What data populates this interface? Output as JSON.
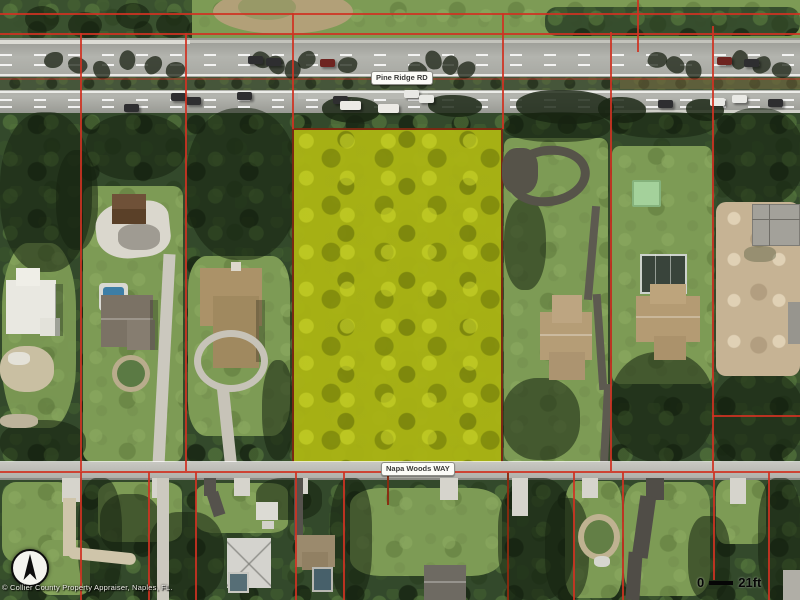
{
  "map": {
    "road_top": {
      "label": "Pine Ridge RD"
    },
    "road_bottom": {
      "label": "Napa Woods WAY"
    },
    "scale_bar": {
      "start": "0",
      "end": "21ft"
    },
    "attribution": "© Collier County Property Appraiser, Naples, FL.",
    "compass": {
      "icon": "north-arrow"
    },
    "colors": {
      "highlight": "#aab414",
      "highlight-border": "#7c2812",
      "parcel-line": "#cf3222",
      "parcel-line-dark": "#8a2a10",
      "road": "#a9aaa4",
      "trees": "#33492b",
      "grass": "#7d9b55"
    }
  }
}
